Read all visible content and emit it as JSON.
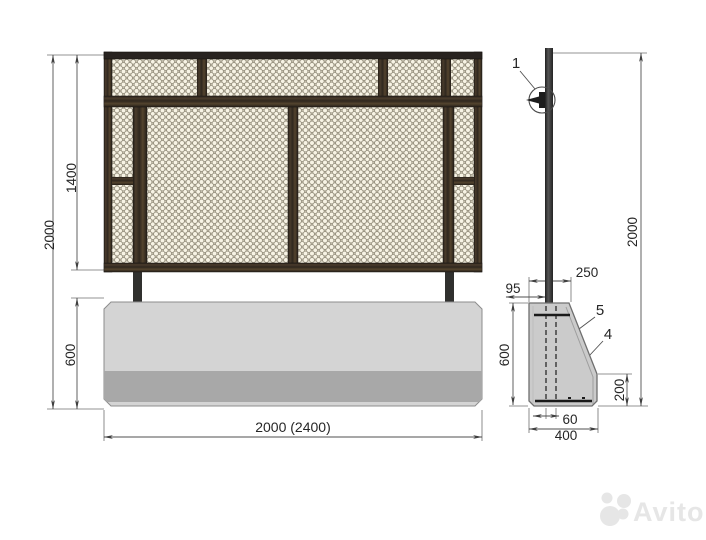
{
  "drawing_type": "fence-panel-technical-drawing",
  "front_view": {
    "height_total": "2000",
    "height_panel": "1400",
    "height_base": "600",
    "width_total": "2000 (2400)"
  },
  "side_view": {
    "height_total": "2000",
    "top_width": "250",
    "post_offset": "95",
    "base_height": "600",
    "back_height": "200",
    "post_width": "60",
    "base_width": "400",
    "callout_post_detail": "1",
    "callout_upper_part": "5",
    "callout_lower_part": "4"
  },
  "watermark": {
    "brand": "Avito"
  },
  "colors": {
    "wood_dark": "#3c3228",
    "mesh_background": "#efe9d6",
    "mesh_wire": "#948e7c",
    "concrete_light": "#d4d4d4",
    "concrete_dark_strip": "#a8a8a8",
    "concrete_side": "#cbcbcb",
    "dim_line": "#4f4f4f",
    "label_text": "#262626",
    "watermark_gray": "#e6e6e6"
  }
}
